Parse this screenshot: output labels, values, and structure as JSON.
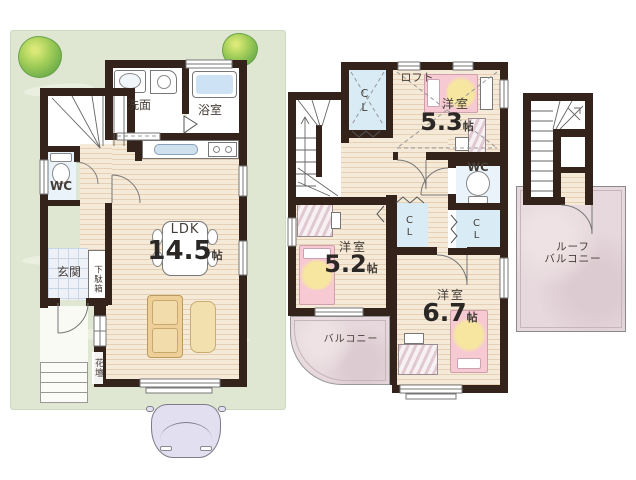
{
  "palette": {
    "wall": "#33231b",
    "wood_floor": "#f5e9d8",
    "lot_green": "#dfe7d2",
    "tree_green": "#74b24b",
    "entrance_tile": "#eef2f8",
    "closet_blue": "#d9ecf6",
    "balcony_pink": "#e6d8dc",
    "bed_pink": "#f6c9d3",
    "bed_yellow": "#f6e6a0",
    "sofa_tan": "#eecf98",
    "water_blue": "#cde2f4"
  },
  "floor1": {
    "washroom": "洗面",
    "bath": "浴室",
    "wc": "WC",
    "ldk_name": "LDK",
    "ldk_size": "14.5",
    "ldk_unit": "帖",
    "entrance": "玄関",
    "shoe_cabinet": "下駄箱",
    "flower_bed": "花壇"
  },
  "floor2": {
    "closet_top": "CL",
    "loft": "ロフト",
    "room1_name": "洋室",
    "room1_size": "5.3",
    "room1_unit": "帖",
    "wc": "WC",
    "closet_mid": "CL",
    "closet_right": "CL",
    "room2_name": "洋室",
    "room2_size": "5.2",
    "room2_unit": "帖",
    "room3_name": "洋室",
    "room3_size": "6.7",
    "room3_unit": "帖",
    "balcony": "バルコニー"
  },
  "floor3": {
    "roof_line1": "ルーフ",
    "roof_line2": "バルコニー"
  }
}
